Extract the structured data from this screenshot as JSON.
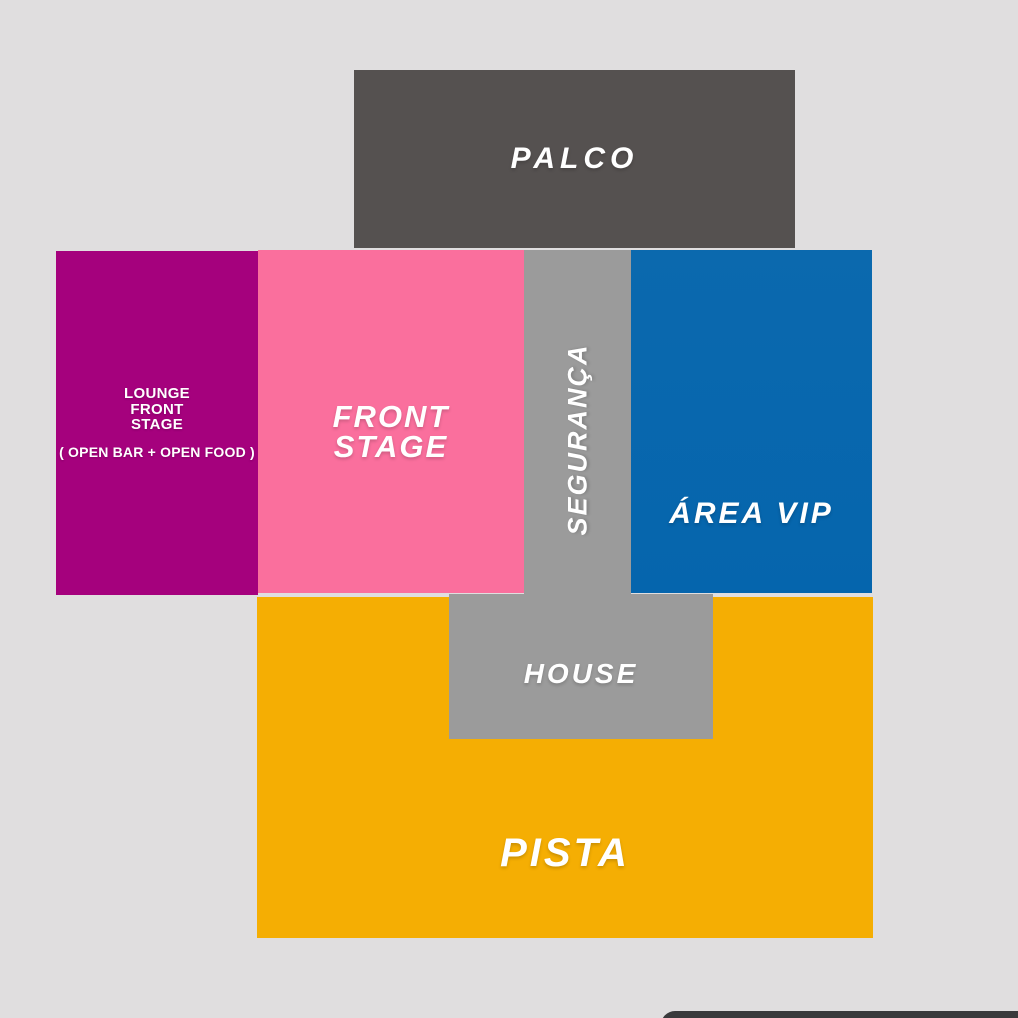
{
  "zones": {
    "palco": {
      "label": "PALCO"
    },
    "lounge": {
      "line1": "LOUNGE",
      "line2": "FRONT",
      "line3": "STAGE",
      "subtitle": "( OPEN BAR + OPEN FOOD )"
    },
    "front_stage": {
      "line1": "FRONT",
      "line2": "STAGE"
    },
    "seguranca": {
      "label": "SEGURANÇA"
    },
    "area_vip": {
      "label": "ÁREA VIP"
    },
    "house": {
      "label": "HOUSE"
    },
    "pista": {
      "label": "PISTA"
    }
  },
  "colors": {
    "background": "#e0dedf",
    "palco": "#555150",
    "lounge": "#a5017d",
    "front_stage": "#fa6f9d",
    "gray_zone": "#9b9b9b",
    "area_vip": "#0565ad",
    "pista": "#f5ae03",
    "bottom_sheet": "#3a3a3c",
    "label_text": "#ffffff"
  }
}
